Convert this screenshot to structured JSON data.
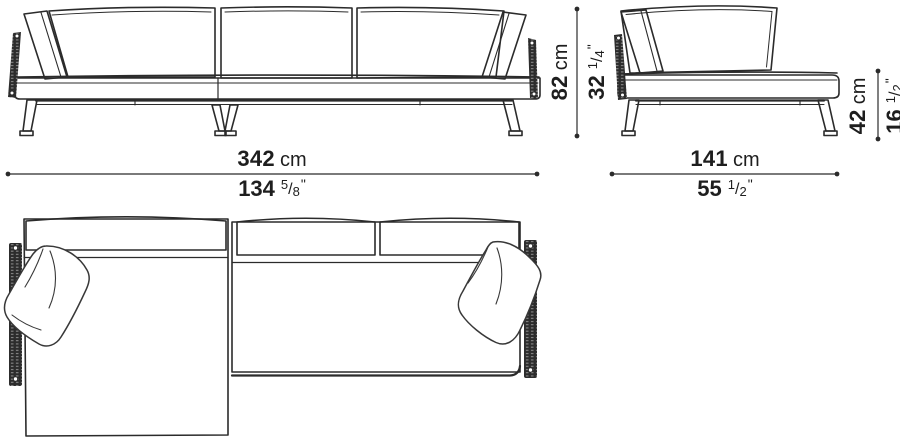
{
  "page": {
    "description": "Technical dimension drawing of a sectional sofa with chaise longue: front elevation, element side elevation and plan view",
    "colors": {
      "background": "#ffffff",
      "ink": "#2b2b2b",
      "hatch_fill": "#2c2c2c",
      "hatch_tick": "#9c9c9c"
    }
  },
  "views": {
    "front": "sofa-front-elevation",
    "side": "element-front-elevation",
    "plan": "sofa-plan-view"
  },
  "dims": {
    "sofa_width": {
      "cm": "342",
      "cm_unit": "cm",
      "inch": "134",
      "num": "5",
      "slash": "/",
      "den": "8",
      "mark": "\""
    },
    "element_width": {
      "cm": "141",
      "cm_unit": "cm",
      "inch": "55",
      "num": "1",
      "slash": "/",
      "den": "2",
      "mark": "\""
    },
    "overall_height": {
      "cm": "82",
      "cm_unit": "cm",
      "inch": "32",
      "num": "1",
      "slash": "/",
      "den": "4",
      "mark": "\""
    },
    "seat_height": {
      "cm": "42",
      "cm_unit": "cm",
      "inch": "16",
      "num": "1",
      "slash": "/",
      "den": "2",
      "mark": "\""
    }
  }
}
